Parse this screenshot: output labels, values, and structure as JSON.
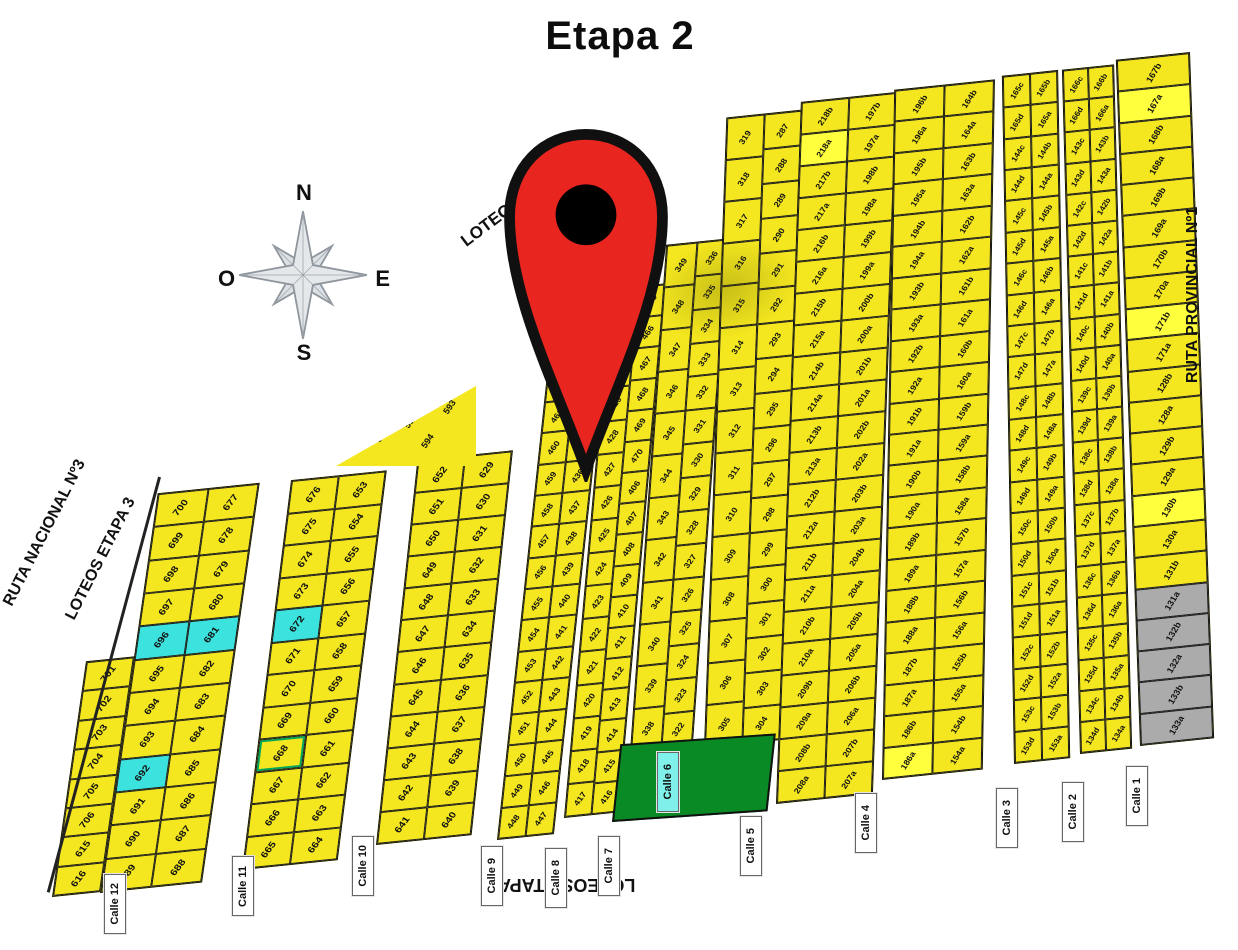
{
  "title": "Etapa 2",
  "compass": {
    "n": "N",
    "s": "S",
    "e": "E",
    "o": "O"
  },
  "pin": {
    "fill": "#E8251F",
    "outline": "#101010",
    "core": "#000000"
  },
  "colors": {
    "lot_yellow": "#F4E71F",
    "lot_bright": "#FFFF3D",
    "lot_cyan": "#3CE3DE",
    "lot_gray": "#ABABAB",
    "park_green": "#0A8A24",
    "pin_red": "#E8251F"
  },
  "edge_labels": [
    {
      "id": "loteos-etapa-3-top",
      "text": "LOTEOS ETAPA 3",
      "x": 408,
      "y": 190,
      "rot": -37,
      "size": 17,
      "w": 225
    },
    {
      "id": "ruta-nacional-3",
      "text": "RUTA NACIONAL Nº3",
      "x": -60,
      "y": 524,
      "rot": -63,
      "size": 16,
      "w": 210
    },
    {
      "id": "loteos-etapa-3-left",
      "text": "LOTEOS ETAPA 3",
      "x": -4,
      "y": 550,
      "rot": -63,
      "size": 16,
      "w": 210
    },
    {
      "id": "ruta-provincial-1",
      "text": "RUTA PROVINCIAL Nº1",
      "x": 1048,
      "y": 286,
      "rot": -90,
      "size": 16,
      "w": 290
    },
    {
      "id": "loteos-etapa-1",
      "text": "LOTEOS ETAPA 1",
      "x": 452,
      "y": 874,
      "rot": 180,
      "size": 18,
      "w": 215
    }
  ],
  "streets": [
    {
      "label": "Calle 12",
      "x": 104,
      "y": 874,
      "variant": "white"
    },
    {
      "label": "Calle 11",
      "x": 232,
      "y": 856,
      "variant": "white"
    },
    {
      "label": "Calle 10",
      "x": 352,
      "y": 836,
      "variant": "white"
    },
    {
      "label": "Calle 9",
      "x": 481,
      "y": 846,
      "variant": "white"
    },
    {
      "label": "Calle 8",
      "x": 545,
      "y": 848,
      "variant": "white"
    },
    {
      "label": "Calle 7",
      "x": 598,
      "y": 836,
      "variant": "white"
    },
    {
      "label": "Calle 6",
      "x": 657,
      "y": 752,
      "variant": "cyan"
    },
    {
      "label": "Calle 5",
      "x": 740,
      "y": 816,
      "variant": "white"
    },
    {
      "label": "Calle 4",
      "x": 855,
      "y": 793,
      "variant": "white"
    },
    {
      "label": "Calle 3",
      "x": 996,
      "y": 788,
      "variant": "white"
    },
    {
      "label": "Calle 2",
      "x": 1062,
      "y": 782,
      "variant": "white"
    },
    {
      "label": "Calle 1",
      "x": 1126,
      "y": 766,
      "variant": "white"
    }
  ],
  "map": {
    "cell_styles": {
      "cyan": [
        "696",
        "681",
        "672",
        "692"
      ],
      "bright": [
        "218a",
        "130b",
        "167a",
        "171b",
        "186a"
      ],
      "gray": [
        "131a",
        "132b",
        "132a",
        "133b",
        "133a"
      ],
      "green_outline": [
        "668"
      ]
    },
    "triangle_block": {
      "left": 336,
      "top": 386,
      "w": 140,
      "h": 80,
      "lots": [
        {
          "n": "590",
          "x": 8,
          "y": 72
        },
        {
          "n": "591",
          "x": 27,
          "y": 55
        },
        {
          "n": "592",
          "x": 48,
          "y": 38
        },
        {
          "n": "593",
          "x": 76,
          "y": 20
        },
        {
          "n": "594",
          "x": 60,
          "y": 62
        }
      ]
    },
    "strips": [
      {
        "id": "wedge-ruta-nacional",
        "left": 52,
        "bottom": 53,
        "w": 46,
        "h": 235,
        "skew": -14,
        "fs": 10,
        "cols": [
          [
            "701",
            "702",
            "703",
            "704",
            "705",
            "706",
            "615",
            "616"
          ]
        ]
      },
      {
        "id": "block-oeste-calle12",
        "left": 100,
        "bottom": 57,
        "w": 98,
        "h": 400,
        "skew": -14,
        "fs": 10,
        "cols": [
          [
            "700",
            "699",
            "698",
            "697",
            "696",
            "695",
            "694",
            "693",
            "692",
            "691",
            "690",
            "689"
          ],
          [
            "677",
            "678",
            "679",
            "680",
            "681",
            "682",
            "683",
            "684",
            "685",
            "686",
            "687",
            "688"
          ]
        ]
      },
      {
        "id": "block-calle12-11",
        "left": 242,
        "bottom": 80,
        "w": 92,
        "h": 390,
        "skew": -13,
        "fs": 10,
        "cols": [
          [
            "676",
            "675",
            "674",
            "673",
            "672",
            "671",
            "670",
            "669",
            "668",
            "667",
            "666",
            "665"
          ],
          [
            "653",
            "654",
            "655",
            "656",
            "657",
            "658",
            "659",
            "660",
            "661",
            "662",
            "663",
            "664"
          ]
        ]
      },
      {
        "id": "block-calle11-10",
        "left": 376,
        "bottom": 105,
        "w": 92,
        "h": 385,
        "skew": -12,
        "fs": 10,
        "cols": [
          [
            "652",
            "651",
            "650",
            "649",
            "648",
            "647",
            "646",
            "645",
            "644",
            "643",
            "642",
            "641"
          ],
          [
            "629",
            "630",
            "631",
            "632",
            "633",
            "634",
            "635",
            "636",
            "637",
            "638",
            "639",
            "640"
          ]
        ]
      },
      {
        "id": "block-calle10-9",
        "left": 497,
        "bottom": 110,
        "w": 54,
        "h": 502,
        "skew": -12,
        "fs": 8.5,
        "cols": [
          [
            "463",
            "462",
            "461",
            "460",
            "459",
            "458",
            "457",
            "456",
            "455",
            "454",
            "453",
            "452",
            "451",
            "450",
            "449",
            "448"
          ],
          [
            "432",
            "433",
            "434",
            "435",
            "436",
            "437",
            "438",
            "439",
            "440",
            "441",
            "442",
            "443",
            "444",
            "445",
            "446",
            "447"
          ]
        ]
      },
      {
        "id": "block-calle9-8",
        "left": 564,
        "bottom": 132,
        "w": 52,
        "h": 530,
        "skew": -11,
        "fs": 8.5,
        "cols": [
          [
            "464",
            "431",
            "430",
            "429",
            "428",
            "427",
            "426",
            "425",
            "424",
            "423",
            "422",
            "421",
            "420",
            "419",
            "418",
            "417"
          ],
          [
            "465",
            "466",
            "467",
            "468",
            "469",
            "470",
            "406",
            "407",
            "408",
            "409",
            "410",
            "411",
            "412",
            "413",
            "414",
            "415",
            "416"
          ]
        ]
      },
      {
        "id": "block-calle8-7",
        "left": 630,
        "bottom": 198,
        "w": 60,
        "h": 508,
        "skew": -10,
        "fs": 8.5,
        "cols": [
          [
            "349",
            "348",
            "347",
            "346",
            "345",
            "344",
            "343",
            "342",
            "341",
            "340",
            "339",
            "338"
          ],
          [
            "336",
            "335",
            "334",
            "333",
            "332",
            "331",
            "330",
            "329",
            "328",
            "327",
            "326",
            "325",
            "324",
            "323",
            "322"
          ]
        ]
      },
      {
        "id": "block-calle7-5",
        "left": 704,
        "bottom": 202,
        "w": 74,
        "h": 632,
        "skew": -8,
        "fs": 8.5,
        "cols": [
          [
            "319",
            "318",
            "317",
            "316",
            "315",
            "314",
            "313",
            "312",
            "311",
            "310",
            "309",
            "308",
            "307",
            "306",
            "305"
          ],
          [
            "287",
            "288",
            "289",
            "290",
            "291",
            "292",
            "293",
            "294",
            "295",
            "296",
            "297",
            "298",
            "299",
            "300",
            "301",
            "302",
            "303",
            "304"
          ]
        ]
      },
      {
        "id": "block-calle5-4",
        "left": 776,
        "bottom": 146,
        "w": 94,
        "h": 704,
        "skew": -8,
        "fs": 8.5,
        "cols": [
          [
            "218b",
            "218a",
            "217b",
            "217a",
            "216b",
            "216a",
            "215b",
            "215a",
            "214b",
            "214a",
            "213b",
            "213a",
            "212b",
            "212a",
            "211b",
            "211a",
            "210b",
            "210a",
            "209b",
            "209a",
            "208b",
            "208a"
          ],
          [
            "197b",
            "197a",
            "198b",
            "198a",
            "199b",
            "199a",
            "200b",
            "200a",
            "201b",
            "201a",
            "202b",
            "202a",
            "203b",
            "203a",
            "204b",
            "204a",
            "205b",
            "205a",
            "206b",
            "206a",
            "207b",
            "207a"
          ]
        ]
      },
      {
        "id": "block-calle4-3",
        "left": 882,
        "bottom": 170,
        "w": 98,
        "h": 692,
        "skew": -7,
        "fs": 8.5,
        "cols": [
          [
            "196b",
            "196a",
            "195b",
            "195a",
            "194b",
            "194a",
            "193b",
            "193a",
            "192b",
            "192a",
            "191b",
            "191a",
            "190b",
            "190a",
            "189b",
            "189a",
            "188b",
            "188a",
            "187b",
            "187a",
            "186b",
            "186a"
          ],
          [
            "164b",
            "164a",
            "163b",
            "163a",
            "162b",
            "162a",
            "161b",
            "161a",
            "160b",
            "160a",
            "159b",
            "159a",
            "158b",
            "158a",
            "157b",
            "157a",
            "156b",
            "156a",
            "155b",
            "155a",
            "154b",
            "154a"
          ]
        ]
      },
      {
        "id": "block-calle3-2",
        "left": 1014,
        "bottom": 186,
        "w": 54,
        "h": 690,
        "skew": -5,
        "fs": 8,
        "cols": [
          [
            "165c",
            "165d",
            "144c",
            "144d",
            "145c",
            "145d",
            "146c",
            "146d",
            "147c",
            "147d",
            "148c",
            "148d",
            "149c",
            "149d",
            "150c",
            "150d",
            "151c",
            "151d",
            "152c",
            "152d",
            "153c",
            "153d"
          ],
          [
            "165b",
            "165a",
            "144b",
            "144a",
            "145b",
            "145a",
            "146b",
            "146a",
            "147b",
            "147a",
            "148b",
            "148a",
            "149b",
            "149a",
            "150b",
            "150a",
            "151b",
            "151a",
            "152b",
            "152a",
            "153b",
            "153a"
          ]
        ]
      },
      {
        "id": "block-calle2-1",
        "left": 1080,
        "bottom": 196,
        "w": 50,
        "h": 686,
        "skew": -4.5,
        "fs": 8,
        "cols": [
          [
            "166c",
            "166d",
            "143c",
            "143d",
            "142c",
            "142d",
            "141c",
            "141d",
            "140c",
            "140d",
            "139c",
            "139d",
            "138c",
            "138d",
            "137c",
            "137d",
            "136c",
            "136d",
            "135c",
            "135d",
            "134c",
            "134d"
          ],
          [
            "166b",
            "166a",
            "143b",
            "143a",
            "142b",
            "142a",
            "141b",
            "141a",
            "140b",
            "140a",
            "139b",
            "139a",
            "138b",
            "138a",
            "137b",
            "137a",
            "136b",
            "136a",
            "135b",
            "135a",
            "134b",
            "134a"
          ]
        ]
      },
      {
        "id": "block-calle1-ruta",
        "left": 1140,
        "bottom": 204,
        "w": 72,
        "h": 688,
        "skew": -4,
        "fs": 9,
        "cols": [
          [
            "167b",
            "167a",
            "168b",
            "168a",
            "169b",
            "169a",
            "170b",
            "170a",
            "171b",
            "171a",
            "128b",
            "128a",
            "129b",
            "129a",
            "130b",
            "130a",
            "131b",
            "131a",
            "132b",
            "132a",
            "133b",
            "133a"
          ]
        ]
      }
    ],
    "green_area": {
      "left": 612,
      "bottom": 128,
      "w": 150,
      "h": 74
    }
  }
}
